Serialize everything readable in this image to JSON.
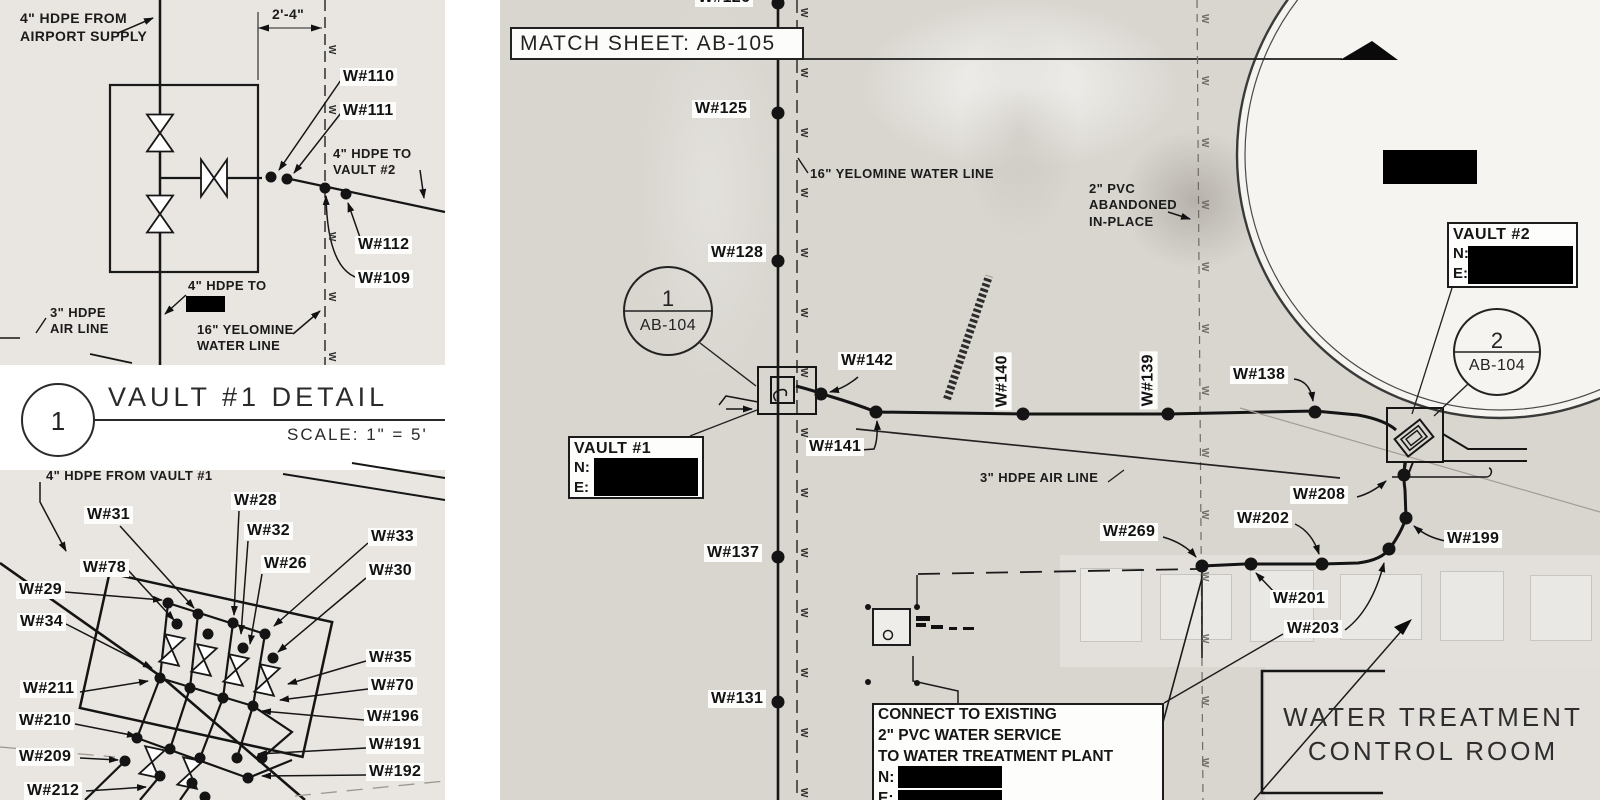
{
  "detailA": {
    "supply": "4\" HDPE FROM\nAIRPORT SUPPLY",
    "dim": "2'-4\"",
    "to_vault2": "4\" HDPE TO\nVAULT #2",
    "hdpe_to": "4\" HDPE TO",
    "air": "3\" HDPE\nAIR LINE",
    "yelomine": "16\" YELOMINE\nWATER LINE",
    "points": [
      {
        "t": "W#110",
        "x": 340,
        "y": 68
      },
      {
        "t": "W#111",
        "x": 340,
        "y": 102
      },
      {
        "t": "W#112",
        "x": 355,
        "y": 236
      },
      {
        "t": "W#109",
        "x": 355,
        "y": 270
      }
    ]
  },
  "title_block": {
    "num": "1",
    "title": "VAULT #1 DETAIL",
    "scale": "SCALE: 1\" = 5'"
  },
  "detailB": {
    "header": "4\" HDPE FROM VAULT #1",
    "points": [
      {
        "t": "W#31",
        "x": 84,
        "y": 506
      },
      {
        "t": "W#78",
        "x": 80,
        "y": 559
      },
      {
        "t": "W#29",
        "x": 16,
        "y": 581
      },
      {
        "t": "W#34",
        "x": 17,
        "y": 613
      },
      {
        "t": "W#211",
        "x": 20,
        "y": 680
      },
      {
        "t": "W#210",
        "x": 16,
        "y": 712
      },
      {
        "t": "W#209",
        "x": 16,
        "y": 748
      },
      {
        "t": "W#212",
        "x": 24,
        "y": 782
      },
      {
        "t": "W#28",
        "x": 231,
        "y": 492
      },
      {
        "t": "W#32",
        "x": 244,
        "y": 522
      },
      {
        "t": "W#26",
        "x": 261,
        "y": 555
      },
      {
        "t": "W#33",
        "x": 368,
        "y": 528
      },
      {
        "t": "W#30",
        "x": 366,
        "y": 562
      },
      {
        "t": "W#35",
        "x": 366,
        "y": 649
      },
      {
        "t": "W#70",
        "x": 368,
        "y": 677
      },
      {
        "t": "W#196",
        "x": 364,
        "y": 708
      },
      {
        "t": "W#191",
        "x": 366,
        "y": 736
      },
      {
        "t": "W#192",
        "x": 366,
        "y": 763
      }
    ]
  },
  "plan": {
    "match_sheet": "MATCH SHEET: AB-105",
    "yelomine_note": "16\" YELOMINE WATER LINE",
    "pvc_note": "2\" PVC\nABANDONED\nIN-PLACE",
    "air_note": "3\" HDPE AIR LINE",
    "building": "WATER TREATMENT\nCONTROL ROOM",
    "callout1": {
      "num": "1",
      "sheet": "AB-104"
    },
    "callout2": {
      "num": "2",
      "sheet": "AB-104"
    },
    "vault1": {
      "title": "VAULT #1",
      "n": "N:",
      "e": "E:"
    },
    "vault2": {
      "title": "VAULT #2",
      "n": "N:",
      "e": "E:"
    },
    "connect": {
      "l1": "CONNECT TO EXISTING",
      "l2": "2\" PVC WATER SERVICE",
      "l3": "TO WATER TREATMENT PLANT",
      "n": "N:",
      "e": "E:"
    },
    "points": [
      {
        "t": "W#126",
        "x": 695,
        "y": -11
      },
      {
        "t": "W#125",
        "x": 692,
        "y": 100
      },
      {
        "t": "W#128",
        "x": 708,
        "y": 244
      },
      {
        "t": "W#137",
        "x": 704,
        "y": 544
      },
      {
        "t": "W#131",
        "x": 708,
        "y": 690
      },
      {
        "t": "W#142",
        "x": 838,
        "y": 352
      },
      {
        "t": "W#141",
        "x": 806,
        "y": 438
      },
      {
        "t": "W#138",
        "x": 1230,
        "y": 366
      },
      {
        "t": "W#208",
        "x": 1290,
        "y": 486
      },
      {
        "t": "W#199",
        "x": 1444,
        "y": 530
      },
      {
        "t": "W#202",
        "x": 1234,
        "y": 510
      },
      {
        "t": "W#269",
        "x": 1100,
        "y": 523
      },
      {
        "t": "W#201",
        "x": 1270,
        "y": 590
      },
      {
        "t": "W#203",
        "x": 1284,
        "y": 620
      },
      {
        "t": "W#140",
        "x": 1012,
        "y": 412,
        "rot": -90
      },
      {
        "t": "W#139",
        "x": 1158,
        "y": 411,
        "rot": -90
      }
    ]
  }
}
